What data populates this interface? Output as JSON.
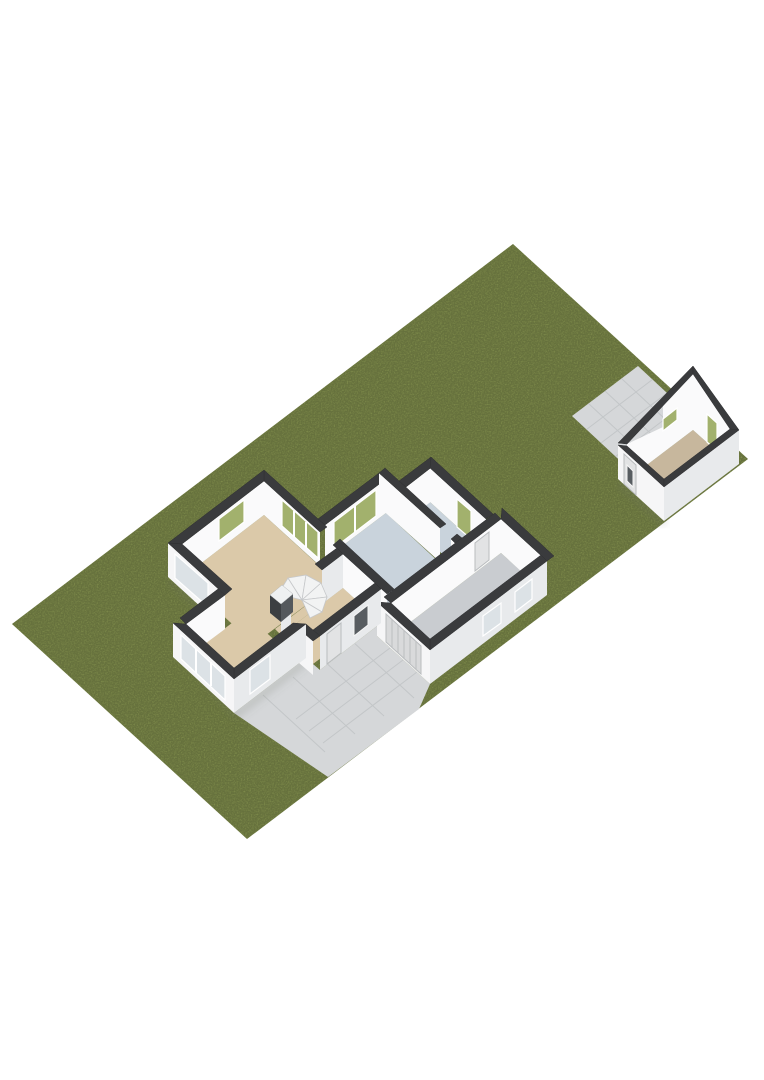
{
  "scene": {
    "type": "3d-floorplan",
    "view": "isometric",
    "description": "Ground-floor 3D floor plan of a house on a long green lot with a detached shed, tiled patio and tiled driveway",
    "background": "#ffffff"
  },
  "rooms": [
    {
      "name": "living-room",
      "floor": "tan",
      "features": [
        "corner-windows",
        "sliding-glass-doors",
        "garden-annex"
      ]
    },
    {
      "name": "hallway",
      "floor": "tan",
      "features": [
        "spiral-staircase",
        "front-door",
        "dark-cabinet"
      ]
    },
    {
      "name": "kitchen",
      "floor": "blue-gray",
      "features": [
        "glazed-garden-door"
      ]
    },
    {
      "name": "utility-room",
      "floor": "blue-gray",
      "features": [
        "small-window"
      ]
    },
    {
      "name": "garage",
      "floor": "gray",
      "features": [
        "roller-door",
        "two-side-windows",
        "interior-door"
      ]
    },
    {
      "name": "shed",
      "floor": "beige",
      "features": [
        "gable-wall",
        "door",
        "small-windows"
      ]
    }
  ],
  "outdoor": [
    {
      "name": "lawn"
    },
    {
      "name": "patio-tiles"
    },
    {
      "name": "driveway-tiles"
    }
  ],
  "colors": {
    "grass": "#8f9e55",
    "grass_speckle": "#5c6b34",
    "tile": "#d5d7d9",
    "tile_line": "#c3c6c8",
    "tan_floor": "#dbc9a9",
    "kitchen_floor": "#c9d3dc",
    "garage_floor": "#c9ccd0",
    "shed_floor": "#c7b79d",
    "wall_top": "#3a3b3d",
    "face_in": "#fafafb",
    "face_sw": "#f6f6f7",
    "face_se": "#e8eaec",
    "glass_green": "#a2b16d",
    "glass_pale": "#dce2e6",
    "glass_dark": "#585d61",
    "door": "#e2e3e4",
    "roller": "#d9dadb",
    "stair": "#f2f3f3",
    "stair_line": "#c6c8ca",
    "cabinet_front": "#3c3f42",
    "cabinet_side": "#54585c",
    "cabinet_top": "#eef0f1"
  }
}
